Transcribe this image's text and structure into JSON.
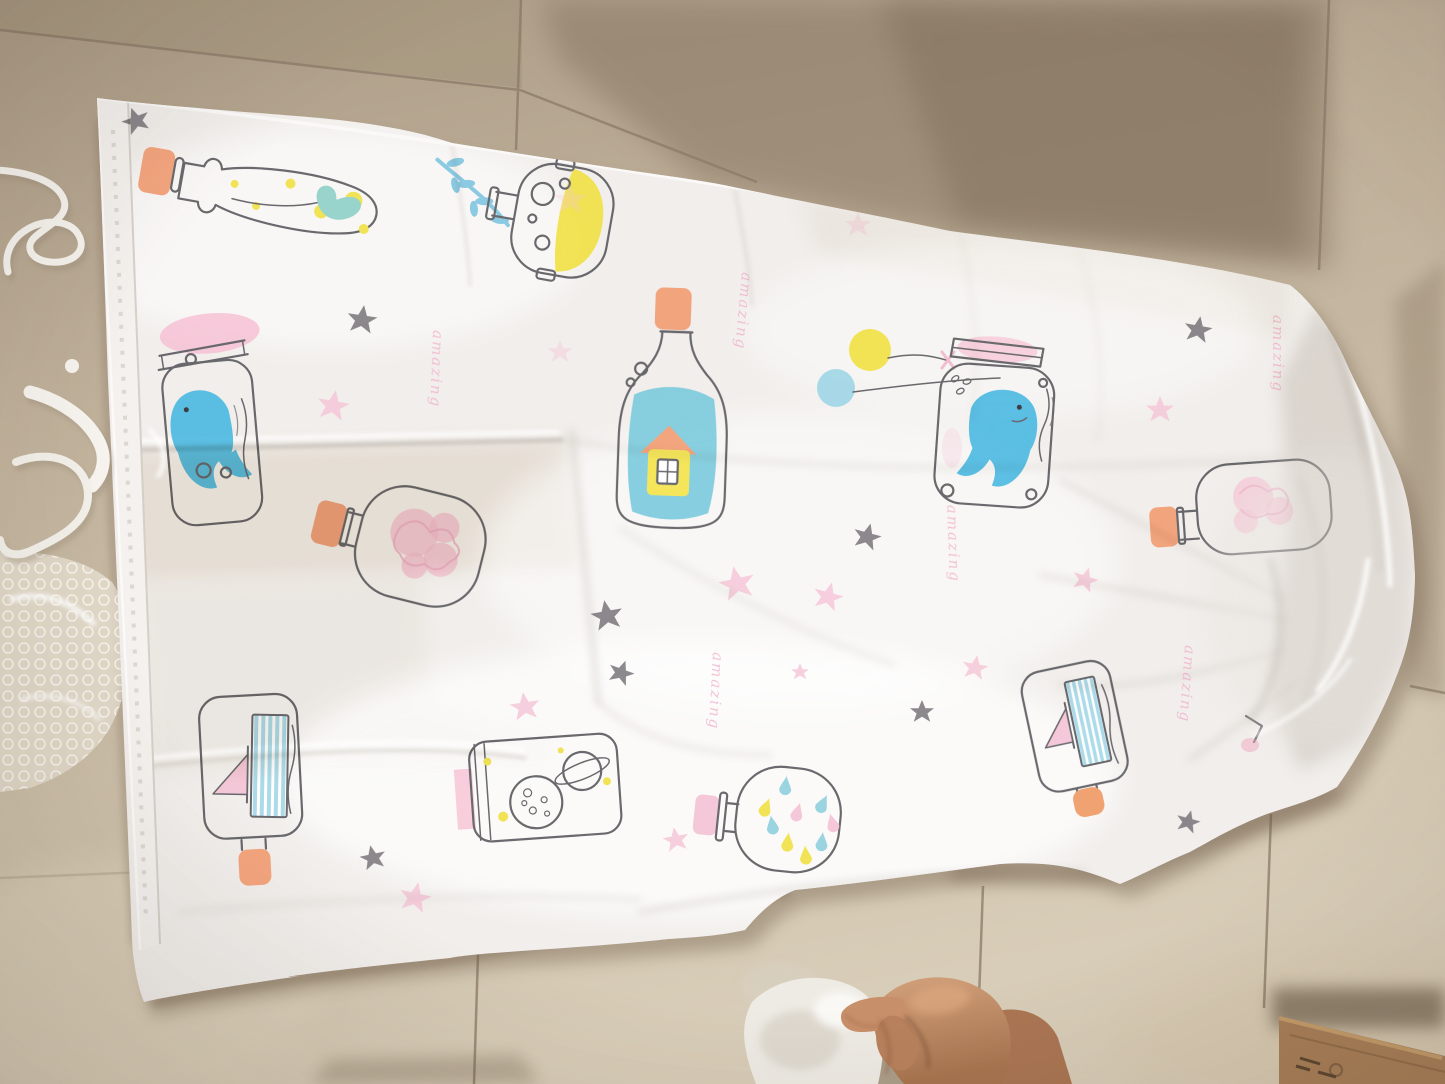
{
  "scene": {
    "kind": "photograph",
    "setting": "beige ceramic tiled floor",
    "subject": "white translucent vacuum storage bag printed with pastel message-in-a-bottle doodles",
    "bag": {
      "script_word": "amazing",
      "print_motifs": [
        "bottle with sprout and yellow dots",
        "teal seaweed branch",
        "round flask half filled yellow",
        "tall bottle with yellow house inside",
        "yellow and blue balloons",
        "jar with blue whale (right)",
        "jar with blue whale (left)",
        "flask with pink flower",
        "jar with striped sailboat (left)",
        "lying jar with moon and ringed planet",
        "flask with colorful drops",
        "jar with striped sailboat (right)",
        "bottle with pink flower (right edge)",
        "gray stars",
        "pink stars"
      ]
    },
    "other_objects": [
      "bubble wrap sheet",
      "white plastic cord and strap",
      "child hand",
      "white cloth",
      "cardboard box corner"
    ],
    "colors": {
      "floor_light": "#d6cbb6",
      "floor_mid": "#c2b39d",
      "floor_shadow": "#84735f",
      "grout": "#8a7a67",
      "bag_white": "#f1eeeb",
      "bag_crease": "#c6bfb8",
      "print_outline": "#5b5b60",
      "cork_orange": "#f29d72",
      "accent_yellow": "#f0e144",
      "water_teal": "#6fc6da",
      "whale_blue": "#4cb9e2",
      "sail_stripe_blue": "#a5d8e8",
      "accent_pink": "#f6bcd2",
      "star_gray": "#6b676d",
      "skin": "#c08a66",
      "cardboard": "#a87f58"
    }
  }
}
